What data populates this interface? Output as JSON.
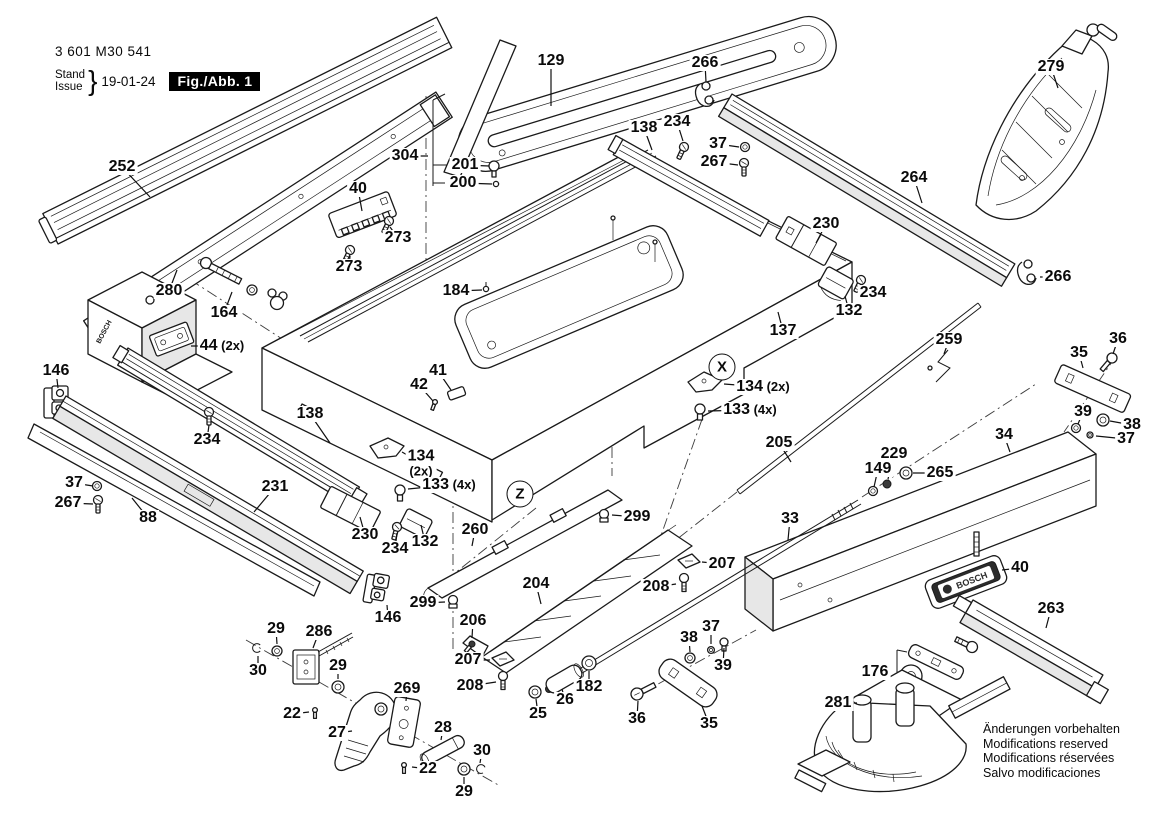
{
  "header": {
    "part_number": "3 601 M30 541",
    "stand_label": "Stand",
    "issue_label": "Issue",
    "brace": "}",
    "date": "19-01-24",
    "figure_label": "Fig./Abb. 1"
  },
  "brand": {
    "name": "BOSCH"
  },
  "footer_notes": [
    "Änderungen vorbehalten",
    "Modifications reserved",
    "Modifications réservées",
    "Salvo modificaciones"
  ],
  "callouts": [
    {
      "id": "252",
      "label": "252",
      "x": 122,
      "y": 167,
      "tx": 150,
      "ty": 197
    },
    {
      "id": "280",
      "label": "280",
      "x": 169,
      "y": 291,
      "tx": 177,
      "ty": 270
    },
    {
      "id": "164",
      "label": "164",
      "x": 224,
      "y": 313,
      "tx": 232,
      "ty": 292
    },
    {
      "id": "44",
      "label": "44 (2x)",
      "x": 222,
      "y": 346,
      "tx": 191,
      "ty": 346
    },
    {
      "id": "146-top",
      "label": "146",
      "x": 56,
      "y": 371,
      "tx": 58,
      "ty": 388
    },
    {
      "id": "129",
      "label": "129",
      "x": 551,
      "y": 61,
      "tx": 551,
      "ty": 106
    },
    {
      "id": "266-top",
      "label": "266",
      "x": 705,
      "y": 63,
      "tx": 706,
      "ty": 82
    },
    {
      "id": "279",
      "label": "279",
      "x": 1051,
      "y": 67,
      "tx": 1058,
      "ty": 88
    },
    {
      "id": "304",
      "label": "304",
      "x": 405,
      "y": 156,
      "tx": 428,
      "ty": 156
    },
    {
      "id": "201",
      "label": "201",
      "x": 465,
      "y": 165,
      "tx": 489,
      "ty": 166
    },
    {
      "id": "200",
      "label": "200",
      "x": 463,
      "y": 183,
      "tx": 492,
      "ty": 184
    },
    {
      "id": "138-top",
      "label": "138",
      "x": 644,
      "y": 128,
      "tx": 652,
      "ty": 150
    },
    {
      "id": "234-top",
      "label": "234",
      "x": 677,
      "y": 122,
      "tx": 683,
      "ty": 141
    },
    {
      "id": "37-top",
      "label": "37",
      "x": 718,
      "y": 144,
      "tx": 739,
      "ty": 147
    },
    {
      "id": "267-top",
      "label": "267",
      "x": 714,
      "y": 162,
      "tx": 738,
      "ty": 165
    },
    {
      "id": "264",
      "label": "264",
      "x": 914,
      "y": 178,
      "tx": 922,
      "ty": 203
    },
    {
      "id": "266-right",
      "label": "266",
      "x": 1058,
      "y": 277,
      "tx": 1040,
      "ty": 277
    },
    {
      "id": "40-top",
      "label": "40",
      "x": 358,
      "y": 189,
      "tx": 362,
      "ty": 211
    },
    {
      "id": "273-a",
      "label": "273",
      "x": 398,
      "y": 238,
      "tx": 390,
      "ty": 227
    },
    {
      "id": "273-b",
      "label": "273",
      "x": 349,
      "y": 267,
      "tx": 350,
      "ty": 256
    },
    {
      "id": "184",
      "label": "184",
      "x": 456,
      "y": 291,
      "tx": 482,
      "ty": 290
    },
    {
      "id": "230-right",
      "label": "230",
      "x": 826,
      "y": 224,
      "tx": 816,
      "ty": 243
    },
    {
      "id": "234-right",
      "label": "234",
      "x": 873,
      "y": 293,
      "tx": 862,
      "ty": 285
    },
    {
      "id": "132-right",
      "label": "132",
      "x": 849,
      "y": 311,
      "tx": 845,
      "ty": 296
    },
    {
      "id": "137",
      "label": "137",
      "x": 783,
      "y": 331,
      "tx": 778,
      "ty": 312
    },
    {
      "id": "134-right",
      "label": "134 (2x)",
      "x": 763,
      "y": 387,
      "tx": 724,
      "ty": 384
    },
    {
      "id": "133-right",
      "label": "133 (4x)",
      "x": 750,
      "y": 410,
      "tx": 708,
      "ty": 411
    },
    {
      "id": "259",
      "label": "259",
      "x": 949,
      "y": 340,
      "tx": 944,
      "ty": 354
    },
    {
      "id": "36-right",
      "label": "36",
      "x": 1118,
      "y": 339,
      "tx": 1113,
      "ty": 354
    },
    {
      "id": "35-right",
      "label": "35",
      "x": 1079,
      "y": 353,
      "tx": 1083,
      "ty": 368
    },
    {
      "id": "39-right",
      "label": "39",
      "x": 1083,
      "y": 412,
      "tx": 1078,
      "ty": 424
    },
    {
      "id": "38-right",
      "label": "38",
      "x": 1132,
      "y": 425,
      "tx": 1110,
      "ty": 421
    },
    {
      "id": "37-right",
      "label": "37",
      "x": 1126,
      "y": 439,
      "tx": 1096,
      "ty": 436
    },
    {
      "id": "34",
      "label": "34",
      "x": 1004,
      "y": 435,
      "tx": 1010,
      "ty": 452
    },
    {
      "id": "205",
      "label": "205",
      "x": 779,
      "y": 443,
      "tx": 791,
      "ty": 462
    },
    {
      "id": "229",
      "label": "229",
      "x": 894,
      "y": 454,
      "tx": 888,
      "ty": 479
    },
    {
      "id": "149",
      "label": "149",
      "x": 878,
      "y": 469,
      "tx": 874,
      "ty": 487
    },
    {
      "id": "265",
      "label": "265",
      "x": 940,
      "y": 473,
      "tx": 913,
      "ty": 473
    },
    {
      "id": "33",
      "label": "33",
      "x": 790,
      "y": 519,
      "tx": 788,
      "ty": 540
    },
    {
      "id": "138-left",
      "label": "138",
      "x": 310,
      "y": 414,
      "tx": 330,
      "ty": 443
    },
    {
      "id": "234-left",
      "label": "234",
      "x": 207,
      "y": 440,
      "tx": 209,
      "ty": 425
    },
    {
      "id": "231",
      "label": "231",
      "x": 275,
      "y": 487,
      "tx": 254,
      "ty": 512
    },
    {
      "id": "37-left",
      "label": "37",
      "x": 74,
      "y": 483,
      "tx": 93,
      "ty": 486
    },
    {
      "id": "267-left",
      "label": "267",
      "x": 68,
      "y": 503,
      "tx": 93,
      "ty": 504
    },
    {
      "id": "88",
      "label": "88",
      "x": 148,
      "y": 518,
      "tx": 132,
      "ty": 498
    },
    {
      "id": "134-left",
      "label": "134",
      "label2": "(2x)",
      "x": 421,
      "y": 463,
      "tx": 402,
      "ty": 452
    },
    {
      "id": "133-left",
      "label": "133 (4x)",
      "x": 449,
      "y": 485,
      "tx": 408,
      "ty": 489
    },
    {
      "id": "230-left",
      "label": "230",
      "x": 365,
      "y": 535,
      "tx": 360,
      "ty": 517
    },
    {
      "id": "234-left2",
      "label": "234",
      "x": 395,
      "y": 549,
      "tx": 397,
      "ty": 533
    },
    {
      "id": "132-left",
      "label": "132",
      "x": 425,
      "y": 542,
      "tx": 421,
      "ty": 525
    },
    {
      "id": "260",
      "label": "260",
      "x": 475,
      "y": 530,
      "tx": 472,
      "ty": 546
    },
    {
      "id": "299-right",
      "label": "299",
      "x": 637,
      "y": 517,
      "tx": 612,
      "ty": 515
    },
    {
      "id": "299-left",
      "label": "299",
      "x": 423,
      "y": 603,
      "tx": 445,
      "ty": 602
    },
    {
      "id": "146-bottom",
      "label": "146",
      "x": 388,
      "y": 618,
      "tx": 387,
      "ty": 605
    },
    {
      "id": "204",
      "label": "204",
      "x": 536,
      "y": 584,
      "tx": 541,
      "ty": 604
    },
    {
      "id": "206",
      "label": "206",
      "x": 473,
      "y": 621,
      "tx": 472,
      "ty": 638
    },
    {
      "id": "207-left",
      "label": "207",
      "x": 468,
      "y": 660,
      "tx": 490,
      "ty": 660
    },
    {
      "id": "208-left",
      "label": "208",
      "x": 470,
      "y": 686,
      "tx": 496,
      "ty": 682
    },
    {
      "id": "207-right",
      "label": "207",
      "x": 722,
      "y": 564,
      "tx": 702,
      "ty": 562
    },
    {
      "id": "208-right",
      "label": "208",
      "x": 656,
      "y": 587,
      "tx": 676,
      "ty": 584
    },
    {
      "id": "25",
      "label": "25",
      "x": 538,
      "y": 714,
      "tx": 536,
      "ty": 699
    },
    {
      "id": "26",
      "label": "26",
      "x": 565,
      "y": 700,
      "tx": 562,
      "ty": 689
    },
    {
      "id": "182",
      "label": "182",
      "x": 589,
      "y": 687,
      "tx": 589,
      "ty": 671
    },
    {
      "id": "36-bottom",
      "label": "36",
      "x": 637,
      "y": 719,
      "tx": 638,
      "ty": 701
    },
    {
      "id": "35-bottom",
      "label": "35",
      "x": 709,
      "y": 724,
      "tx": 702,
      "ty": 706
    },
    {
      "id": "38-bottom",
      "label": "38",
      "x": 689,
      "y": 638,
      "tx": 690,
      "ty": 652
    },
    {
      "id": "37-bottom",
      "label": "37",
      "x": 711,
      "y": 627,
      "tx": 711,
      "ty": 644
    },
    {
      "id": "39-bottom",
      "label": "39",
      "x": 723,
      "y": 666,
      "tx": 724,
      "ty": 648
    },
    {
      "id": "40-right",
      "label": "40",
      "x": 1020,
      "y": 568,
      "tx": 1002,
      "ty": 570
    },
    {
      "id": "263",
      "label": "263",
      "x": 1051,
      "y": 609,
      "tx": 1046,
      "ty": 628
    },
    {
      "id": "176",
      "label": "176",
      "x": 875,
      "y": 672,
      "tx": 886,
      "ty": 672
    },
    {
      "id": "281",
      "label": "281",
      "x": 838,
      "y": 703,
      "tx": 857,
      "ty": 703
    },
    {
      "id": "29-a",
      "label": "29",
      "x": 276,
      "y": 629,
      "tx": 277,
      "ty": 644
    },
    {
      "id": "286",
      "label": "286",
      "x": 319,
      "y": 632,
      "tx": 313,
      "ty": 648
    },
    {
      "id": "30-a",
      "label": "30",
      "x": 258,
      "y": 671,
      "tx": 258,
      "ty": 656
    },
    {
      "id": "29-b",
      "label": "29",
      "x": 338,
      "y": 666,
      "tx": 338,
      "ty": 679
    },
    {
      "id": "22-a",
      "label": "22",
      "x": 292,
      "y": 714,
      "tx": 309,
      "ty": 712
    },
    {
      "id": "27",
      "label": "27",
      "x": 337,
      "y": 733,
      "tx": 352,
      "ty": 731
    },
    {
      "id": "269",
      "label": "269",
      "x": 407,
      "y": 689,
      "tx": 406,
      "ty": 701
    },
    {
      "id": "28",
      "label": "28",
      "x": 443,
      "y": 728,
      "tx": 441,
      "ty": 740
    },
    {
      "id": "22-b",
      "label": "22",
      "x": 428,
      "y": 769,
      "tx": 412,
      "ty": 767
    },
    {
      "id": "30-b",
      "label": "30",
      "x": 482,
      "y": 751,
      "tx": 480,
      "ty": 763
    },
    {
      "id": "29-c",
      "label": "29",
      "x": 464,
      "y": 792,
      "tx": 464,
      "ty": 777
    },
    {
      "id": "41",
      "label": "41",
      "x": 438,
      "y": 371,
      "tx": 451,
      "ty": 390
    },
    {
      "id": "42",
      "label": "42",
      "x": 419,
      "y": 385,
      "tx": 433,
      "ty": 401
    },
    {
      "id": "marker-x",
      "label": "X",
      "x": 722,
      "y": 367,
      "circled": true
    },
    {
      "id": "marker-z",
      "label": "Z",
      "x": 520,
      "y": 494,
      "circled": true
    }
  ]
}
